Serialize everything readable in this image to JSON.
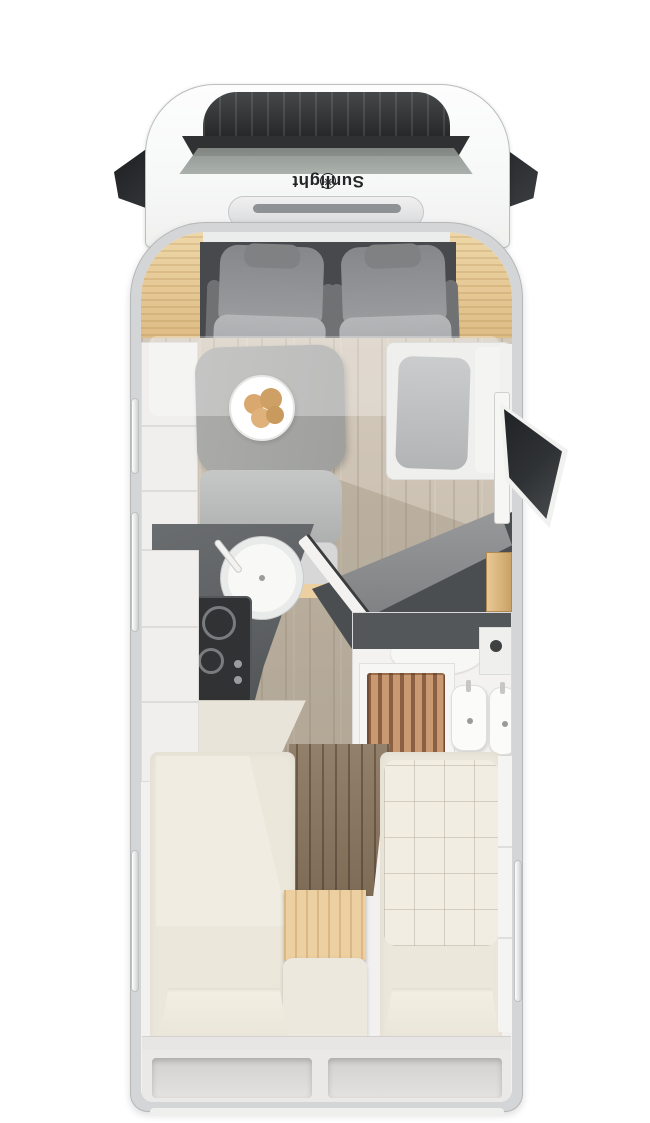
{
  "image": {
    "kind": "motorhome floor plan, rendered top view",
    "width": 650,
    "height": 1123
  },
  "brand": {
    "logo_text": "Sunlight",
    "logo_mark": "✳"
  },
  "palette": {
    "page-bg": "#ffffff",
    "cab-white": "#f7f8f8",
    "outline": "#bcbdbe",
    "vent-dark": "#2c2e30",
    "windshield": "#a4aaa6",
    "logo-ink": "#232526",
    "shell": "#d4d5d6",
    "interior": "#f2f1ef",
    "wood-trim-light": "#eed7a8",
    "wood-trim-dark": "#dcb981",
    "cab-floor": "#47494c",
    "seat-dark": "#9a9c9e",
    "seat-light": "#b4b6b8",
    "table": "#9fa09e",
    "floor-wood": "#c2b7a8",
    "cushion": "#c6c7c7",
    "bench-back": "#d6d7d6",
    "counter": "#5c5f61",
    "hob": "#303234",
    "cream": "#ece7db",
    "step-wood": "#ecd0a2",
    "dark-wood": "#7e6c57",
    "partition": "#4b4e50",
    "panel": "#97999a",
    "shower-wood": "#c99a72",
    "shower-slat": "#8a5f43",
    "door-glass": "#2f3234"
  },
  "areas": {
    "cab": [
      "left-mirror",
      "right-mirror",
      "roof-vent-panel",
      "windshield",
      "brand-logo",
      "hood-vent",
      "driver-seat",
      "passenger-seat"
    ],
    "lounge": [
      "dinette-table",
      "plate-with-bread",
      "dinette-bench",
      "seat-belts",
      "side-bench",
      "skylight-overlay",
      "entry-door"
    ],
    "kitchen": [
      "worktop",
      "round-sink",
      "faucet",
      "gas-hob",
      "tall-cabinet"
    ],
    "bathroom": [
      "shower-grate",
      "toilet",
      "washbasins",
      "vanity-cabinet"
    ],
    "bedroom": [
      "single-bed-left",
      "single-bed-right",
      "center-steps",
      "pillows",
      "wardrobe-partition"
    ],
    "rear": [
      "storage-ledge",
      "latch-handles",
      "garage-compartments"
    ],
    "shell": [
      "body-wall",
      "side-windows",
      "wood-corner-trim"
    ]
  }
}
